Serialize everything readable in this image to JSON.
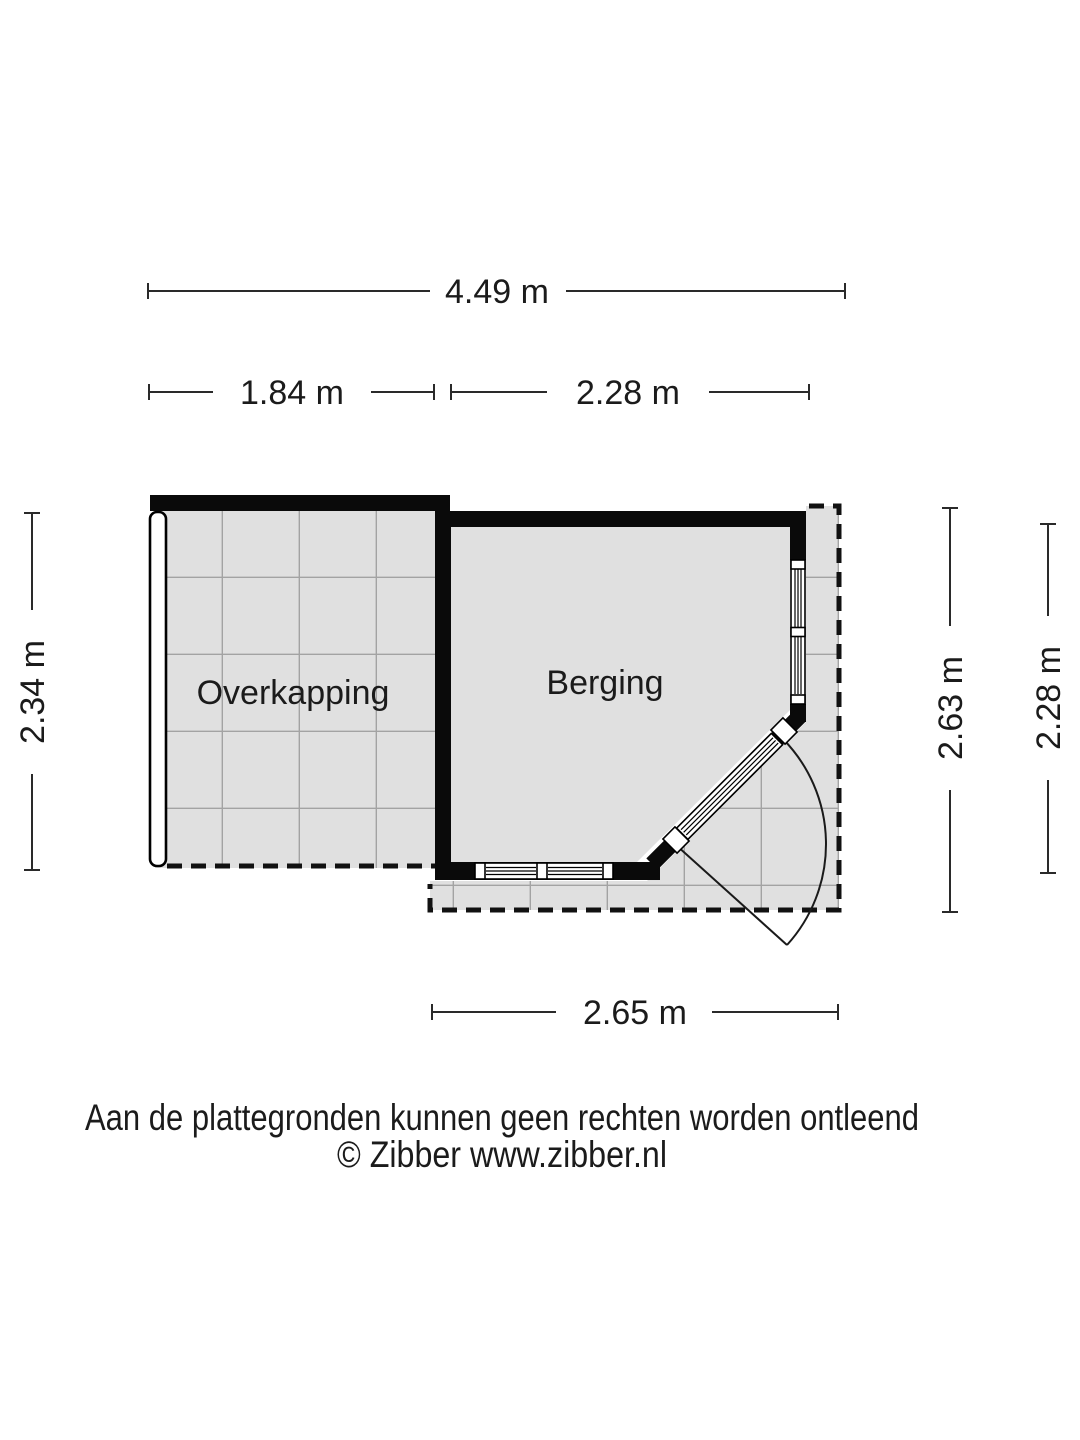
{
  "plan": {
    "rooms": [
      {
        "label": "Overkapping"
      },
      {
        "label": "Berging"
      }
    ],
    "dimensions": {
      "total_width": "4.49 m",
      "overkapping_width": "1.84 m",
      "berging_width_top": "2.28 m",
      "overkapping_height": "2.34 m",
      "berging_height_outer": "2.63 m",
      "berging_height_inner": "2.28 m",
      "berging_width_bottom": "2.65 m"
    },
    "colors": {
      "wall": "#0a0a0a",
      "floor": "#e0e0e0",
      "grid_line": "#a3a3a3",
      "dimension": "#2a2a2a",
      "background": "#ffffff"
    }
  },
  "footer": {
    "disclaimer": "Aan de plattegronden kunnen geen rechten worden ontleend",
    "credit": "© Zibber www.zibber.nl"
  }
}
